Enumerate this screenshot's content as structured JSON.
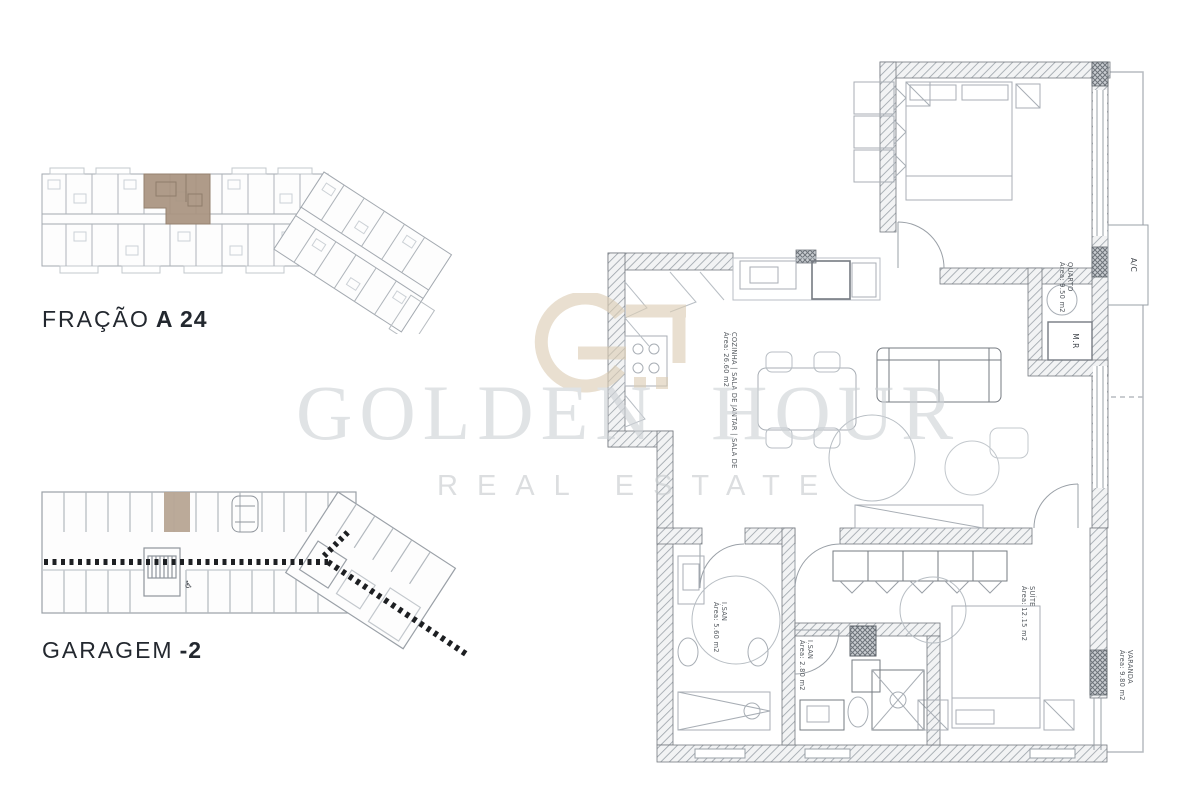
{
  "watermark": {
    "brand": "GOLDEN HOUR",
    "tagline": "REAL ESTATE",
    "logo_color": "#dccdb4",
    "text_color": "#ced2d6"
  },
  "sections": {
    "fraction": {
      "label": "FRAÇÃO",
      "value": "A 24",
      "highlight_color": "#a8937f"
    },
    "garage": {
      "label": "GARAGEM",
      "value": "-2",
      "highlight_color": "#b7a593"
    }
  },
  "apartment": {
    "rooms": {
      "quarto": {
        "name": "QUARTO",
        "area": "Área: 9.50 m2"
      },
      "cozinha": {
        "name": "COZINHA | SALA DE JANTAR | SALA DE",
        "area": "Área: 26.60 m2"
      },
      "isan1": {
        "name": "I.SAN",
        "area": "Área: 5.60 m2"
      },
      "isan2": {
        "name": "I.SAN",
        "area": "Área: 2.80 m2"
      },
      "suite": {
        "name": "SUÍTE",
        "area": "Área: 12.15 m2"
      },
      "varanda": {
        "name": "VARANDA",
        "area": "Área: 9.80 m2"
      }
    },
    "equipment": {
      "ac": {
        "label": "A/C"
      },
      "mr": {
        "label": "M.R"
      }
    }
  },
  "garage_icons": {
    "accessible": "♿"
  }
}
